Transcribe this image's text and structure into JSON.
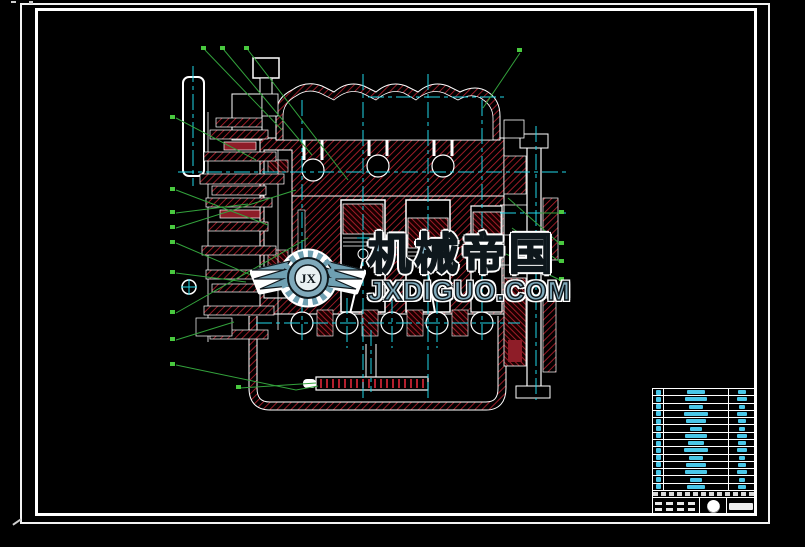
{
  "sheet": {
    "background": "#000000",
    "border_color": "#ffffff"
  },
  "watermark": {
    "logo_text": "JX",
    "title": "机械帝国",
    "url": "JXDIGUO.COM",
    "fill_color": "#7fa9ba",
    "outline_color": "#0e171c",
    "halo_color": "#ffffff"
  },
  "drawing": {
    "type": "engine-cross-section",
    "outline_color": "#ffffff",
    "hatch_color": "#b4202e",
    "centerline_color": "#1fd6e8",
    "leader_color": "#33a23c",
    "callout_counts": {
      "top_left": 3,
      "top_right": 1,
      "left": 9,
      "right": 4,
      "bottom": 1
    }
  },
  "title_block": {
    "row_count": 14,
    "accent_color": "#49c7e8",
    "name_blob_widths": [
      18,
      22,
      14,
      24,
      20,
      12,
      22,
      16,
      24,
      14,
      20,
      22,
      12,
      18
    ],
    "qty_blob_widths": [
      8,
      10,
      6,
      10,
      8,
      6,
      10,
      8,
      10,
      6,
      8,
      10,
      6,
      8
    ]
  }
}
